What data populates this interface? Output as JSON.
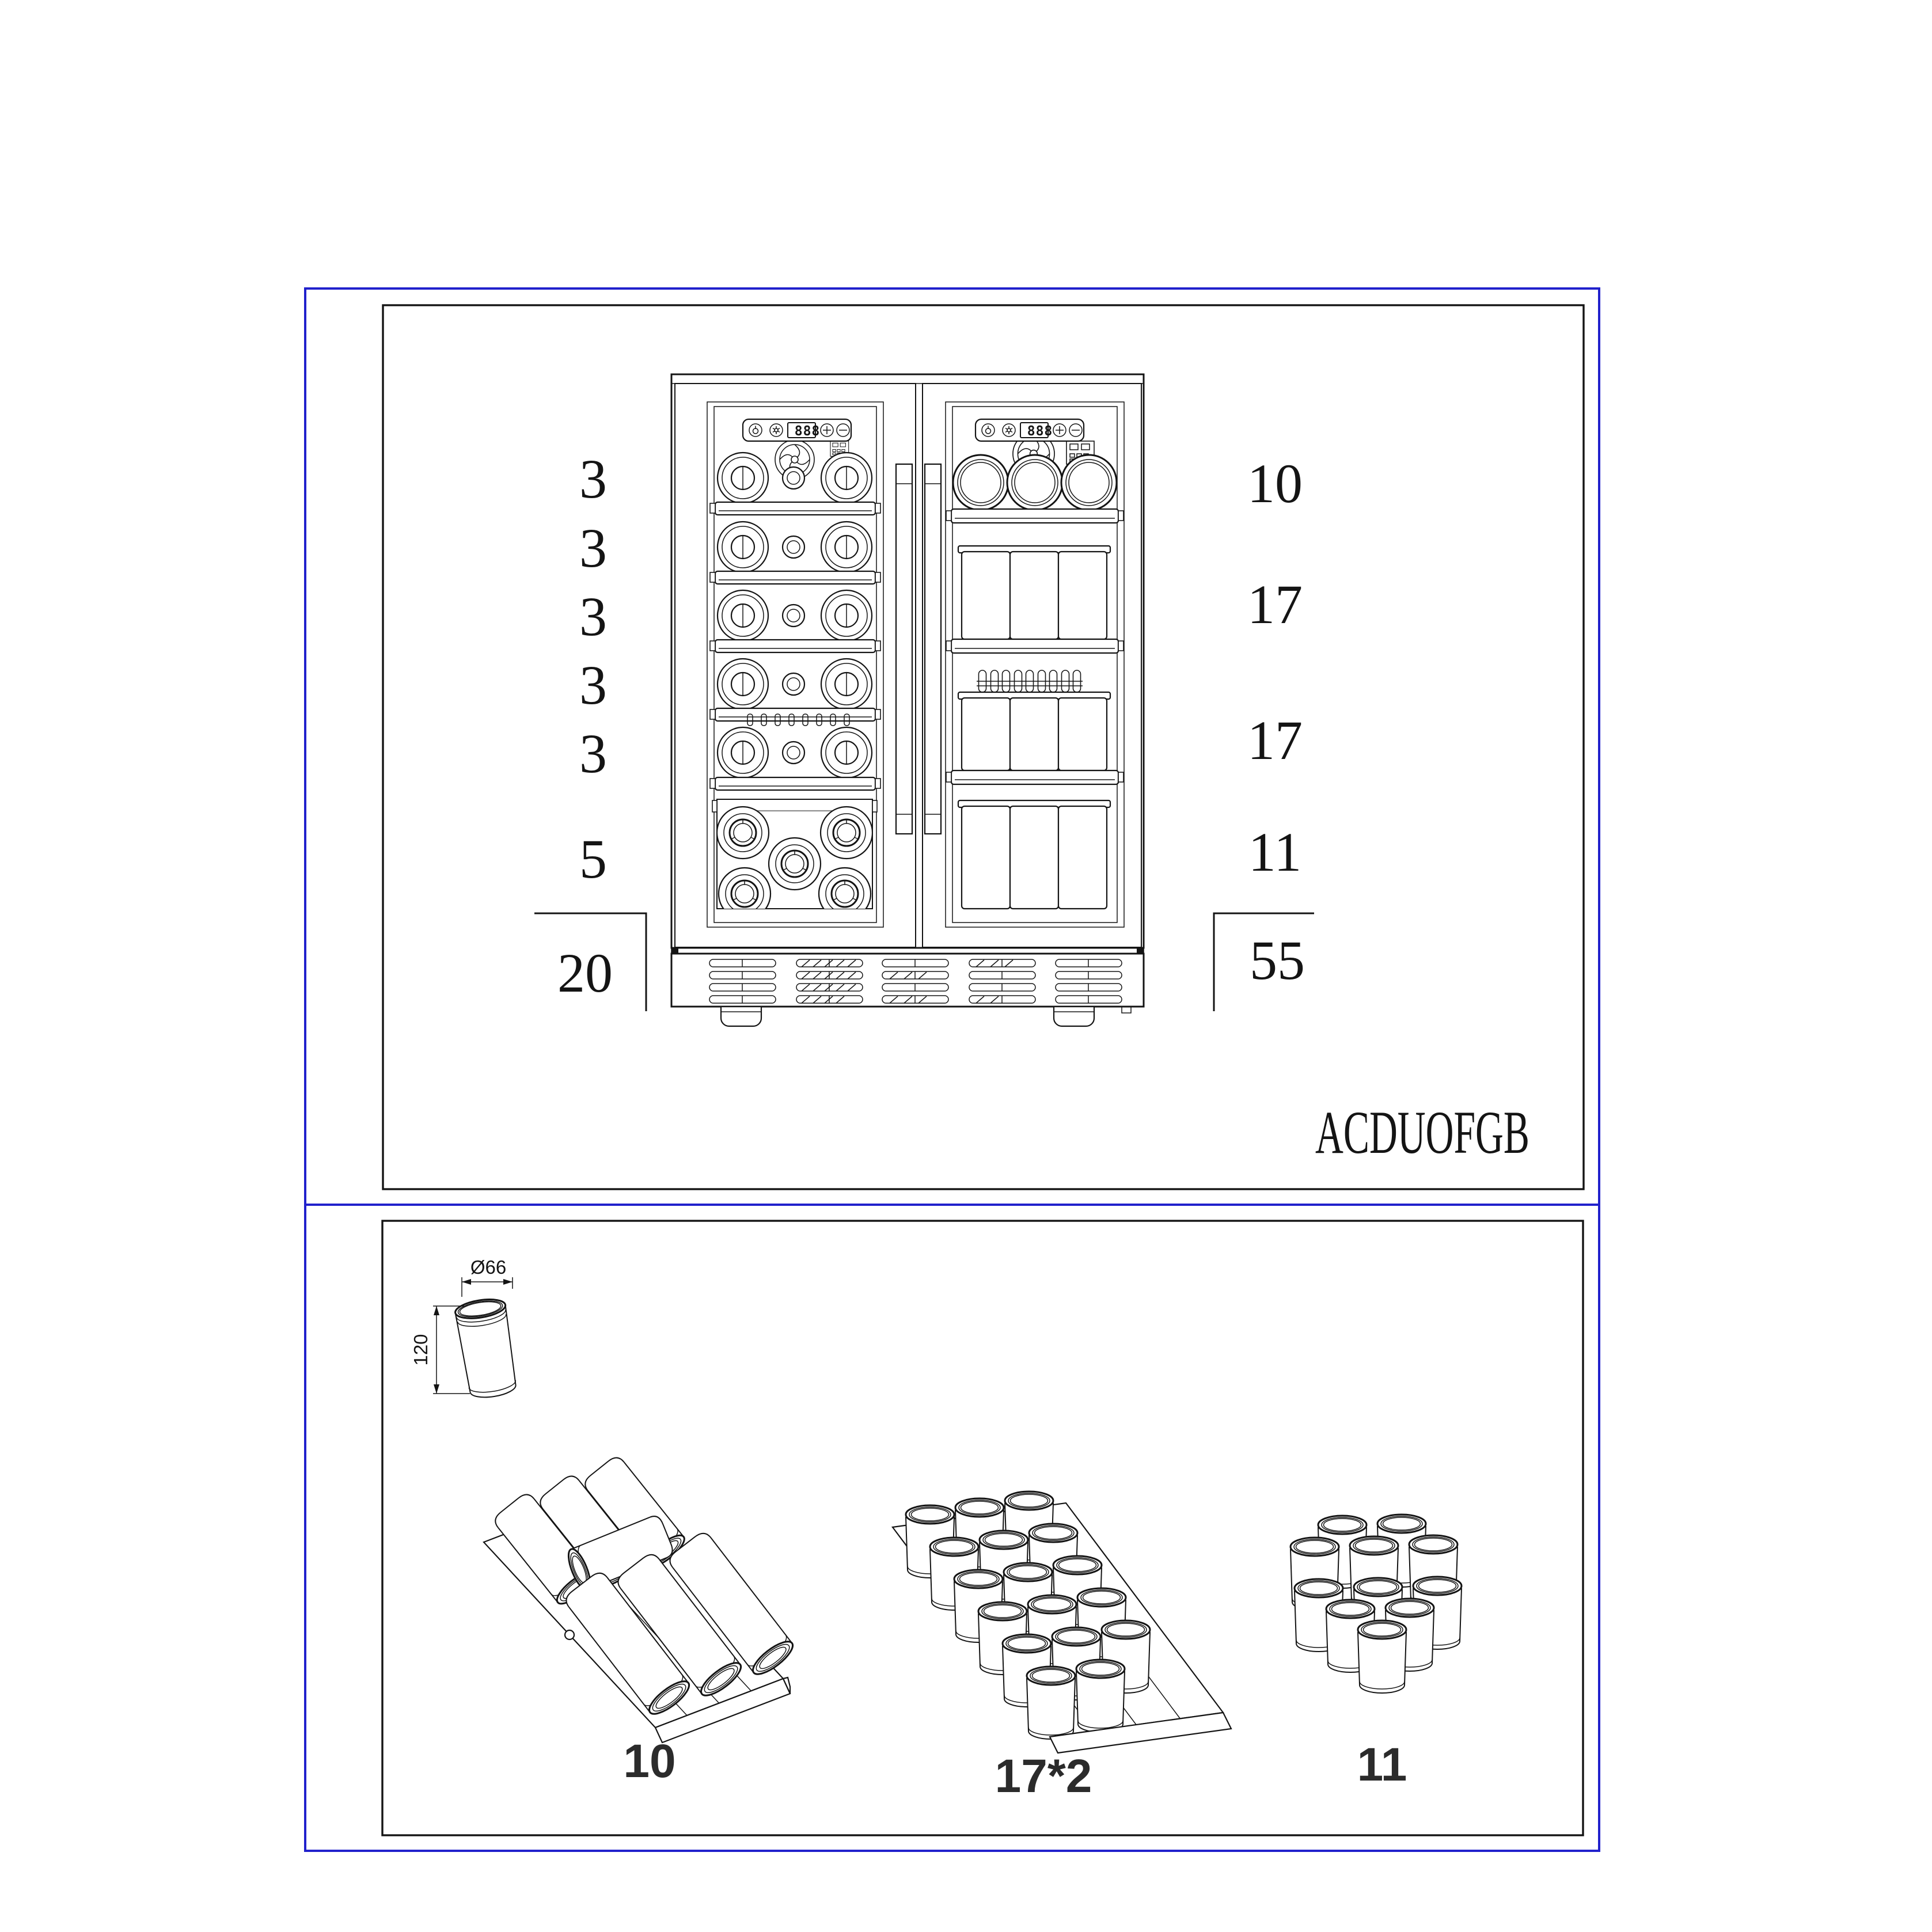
{
  "colors": {
    "frame_blue": "#2121cc",
    "ink": "#141414",
    "accent_gray": "#8f8f8f",
    "label_dark": "#2b2b2b"
  },
  "top_panel": {
    "left_zone": {
      "shelf_counts": [
        "3",
        "3",
        "3",
        "3",
        "3"
      ],
      "bottom_count": "5",
      "total": "20",
      "display_value": "888"
    },
    "right_zone": {
      "shelf_counts": [
        "10",
        "17",
        "17"
      ],
      "bottom_count": "11",
      "total": "55",
      "display_value": "888"
    },
    "model_code": "ACDUOFGB"
  },
  "bottom_panel": {
    "can_spec": {
      "diameter_label": "Ø66",
      "height_label": "120"
    },
    "arrangements": [
      {
        "label": "10"
      },
      {
        "label": "17*2"
      },
      {
        "label": "11"
      }
    ]
  }
}
